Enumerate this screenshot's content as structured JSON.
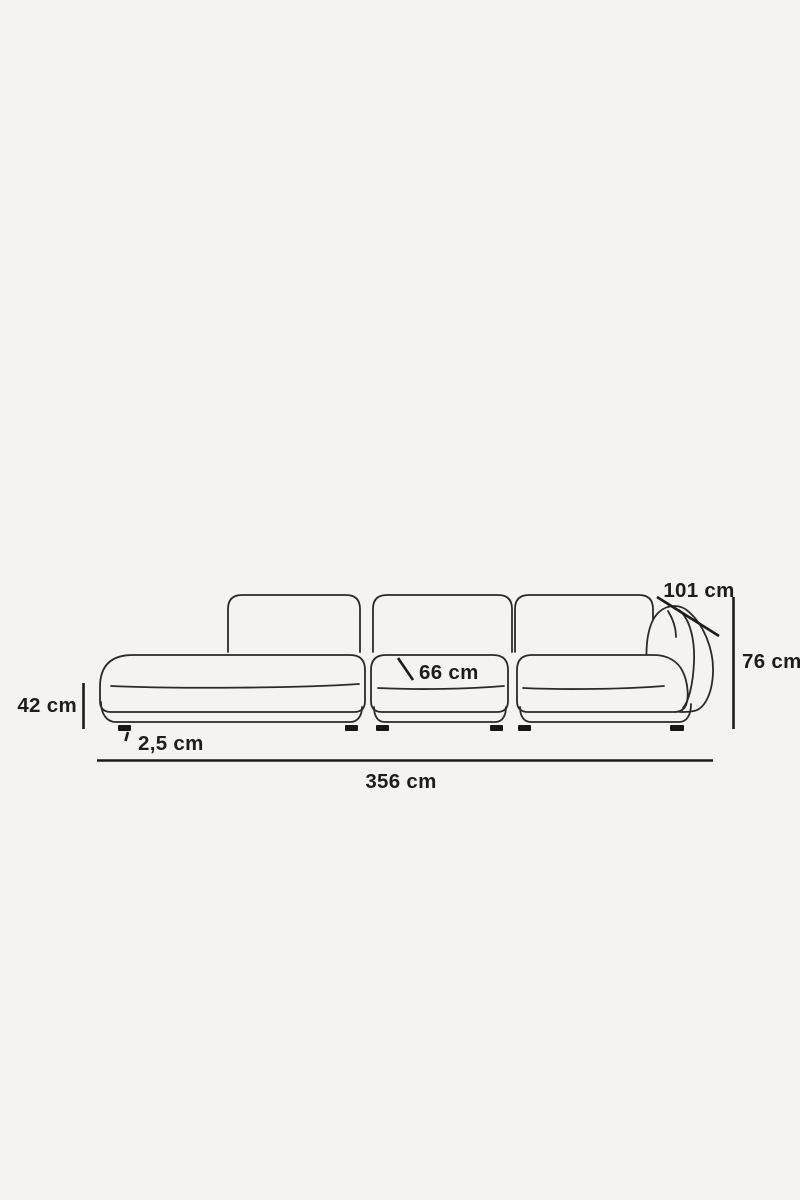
{
  "page": {
    "background_color": "#f4f3f1"
  },
  "diagram": {
    "name": "corner-sofa-dimension-drawing",
    "line_color": "#1d1d1b",
    "dimensions": {
      "seat_height": {
        "label": "42 cm",
        "value_cm": 42
      },
      "leg_height": {
        "label": "2,5 cm",
        "value_cm": 2.5
      },
      "seat_depth": {
        "label": "66 cm",
        "value_cm": 66
      },
      "total_depth": {
        "label": "101 cm",
        "value_cm": 101
      },
      "total_height": {
        "label": "76 cm",
        "value_cm": 76
      },
      "total_width": {
        "label": "356 cm",
        "value_cm": 356
      }
    }
  }
}
